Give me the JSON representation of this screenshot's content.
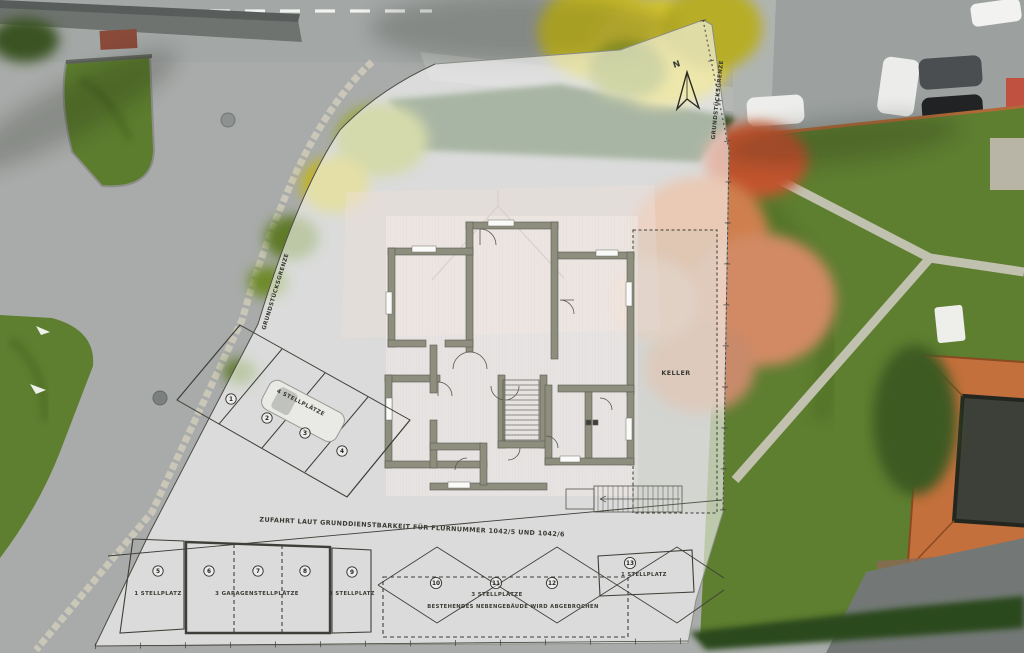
{
  "plan": {
    "north_label": "N",
    "boundary_label_left": "GRUNDSTÜCKSGRENZE",
    "boundary_label_right": "GRUNDSTÜCKSGRENZE",
    "basement_label": "KELLER",
    "driveway_note": "ZUFAHRT LAUT GRUNDDIENSTBARKEIT FÜR FLURNUMMER 1042/5 UND 1042/6",
    "parking": {
      "west_row": {
        "numbers": [
          "1",
          "2",
          "3",
          "4"
        ],
        "label": "4 STELLPLÄTZE"
      },
      "stall_5": {
        "number": "5",
        "label": "1 STELLPLATZ"
      },
      "garage": {
        "numbers": [
          "6",
          "7",
          "8"
        ],
        "label": "3 GARAGENSTELLPLÄTZE"
      },
      "stall_9": {
        "number": "9",
        "label": "1 STELLPLATZ"
      },
      "demolition_area": {
        "numbers": [
          "10",
          "11",
          "12"
        ],
        "label": "3 STELLPLÄTZE",
        "note": "BESTEHENDES NEBENGEBÄUDE WIRD ABGEBROCHEN"
      },
      "stall_13": {
        "number": "13",
        "label": "1 STELLPLATZ"
      }
    }
  },
  "colors": {
    "overlay_white": "#fbfcfb",
    "plan_wall": "#8e8e7e",
    "plan_line": "#3f3f39",
    "grass": "#5e7e30",
    "asphalt": "#a8aba9",
    "roof_orange": "#c4703c",
    "autumn_tree": "#cf7f4e",
    "yellow_tree": "#cfc22a"
  }
}
